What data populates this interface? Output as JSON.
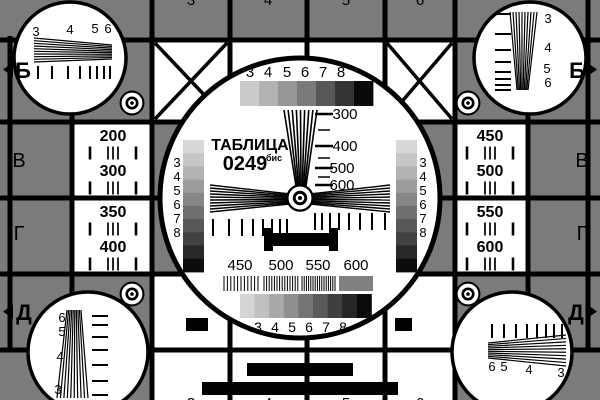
{
  "card": {
    "title": "ТАБЛИЦА",
    "code": "0249",
    "code_suffix": "бис",
    "colors": {
      "background": "#7b7b7b",
      "ink": "#000000",
      "paper": "#ffffff"
    },
    "edge_letters": {
      "b_left": "Б",
      "b_right": "Б",
      "v_left": "В",
      "v_right": "В",
      "g_left": "Г",
      "g_right": "Г",
      "d_left": "Д",
      "d_right": "Д"
    },
    "top_edge_digits": [
      "3",
      "4",
      "5",
      "6"
    ],
    "bottom_edge_digits": [
      "3",
      "4",
      "5",
      "6"
    ],
    "corners": {
      "top_left_wedge_numbers": [
        "3",
        "4",
        "5",
        "6"
      ],
      "top_right_wedge_numbers": [
        "3",
        "4",
        "5",
        "6"
      ],
      "bottom_left_wedge_numbers": [
        "6",
        "5",
        "4",
        "3"
      ],
      "bottom_right_wedge_numbers": [
        "6",
        "5",
        "4",
        "3"
      ]
    },
    "side_cells": {
      "left": [
        "200",
        "300",
        "350",
        "400"
      ],
      "right": [
        "450",
        "500",
        "550",
        "600"
      ]
    },
    "center": {
      "top_gray_digits": [
        "3",
        "4",
        "5",
        "6",
        "7",
        "8"
      ],
      "bottom_gray_digits": [
        "3",
        "4",
        "5",
        "6",
        "7",
        "8"
      ],
      "left_gray_digits": [
        "3",
        "4",
        "5",
        "6",
        "7",
        "8"
      ],
      "right_gray_digits": [
        "3",
        "4",
        "5",
        "6",
        "7",
        "8"
      ],
      "wedge_scale_labels": [
        "300",
        "400",
        "500",
        "600"
      ],
      "frequency_labels": [
        "450",
        "500",
        "550",
        "600"
      ],
      "grayscale_top": [
        "#cacaca",
        "#b2b2b2",
        "#979797",
        "#7a7a7a",
        "#575757",
        "#333333",
        "#0a0a0a"
      ],
      "grayscale_bottom": [
        "#d4d4d4",
        "#c0c0c0",
        "#a9a9a9",
        "#8f8f8f",
        "#757575",
        "#5a5a5a",
        "#3f3f3f",
        "#262626",
        "#0b0b0b"
      ],
      "grayscale_vertical": [
        "#d8d8d8",
        "#c6c6c6",
        "#b2b2b2",
        "#9c9c9c",
        "#868686",
        "#6f6f6f",
        "#585858",
        "#414141",
        "#282828",
        "#0c0c0c"
      ]
    }
  }
}
